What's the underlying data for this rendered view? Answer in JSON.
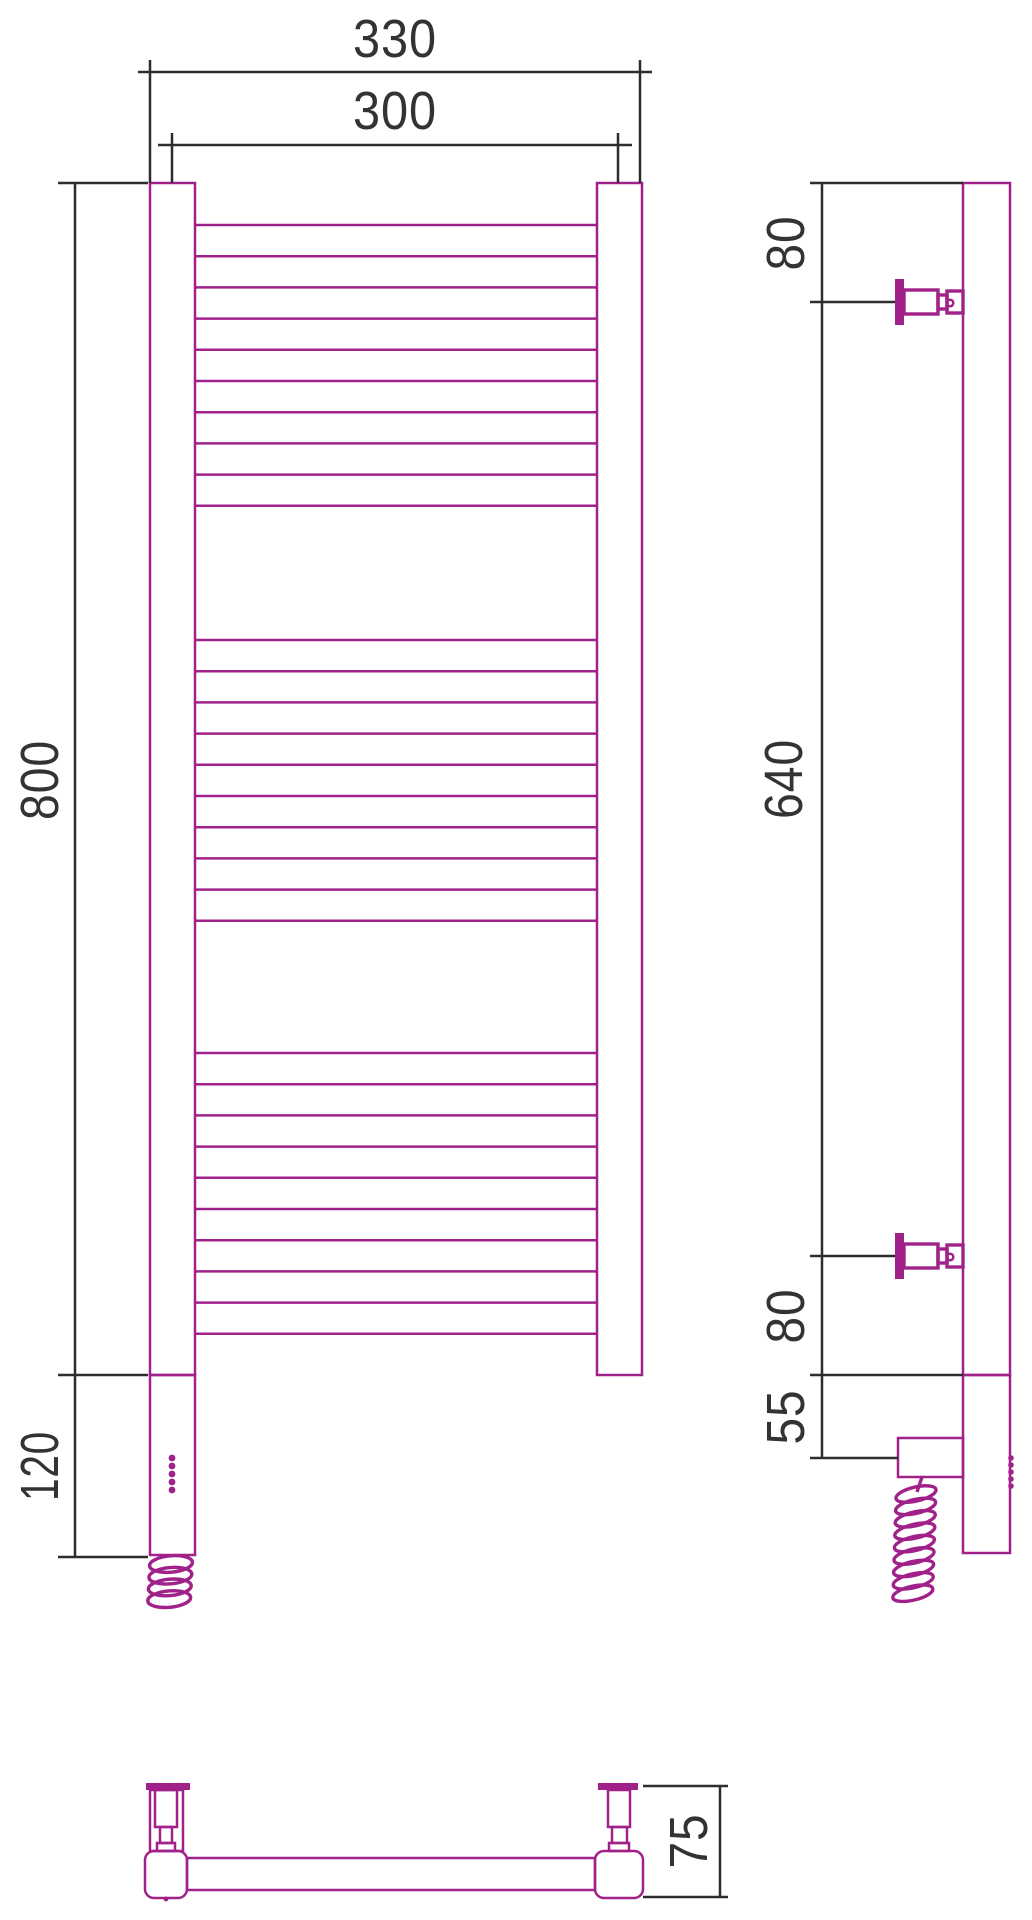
{
  "drawing": {
    "colors": {
      "outline": "#A02189",
      "dimension_lines": "#2D2D2D",
      "label_text": "#333333",
      "background": "#FFFFFF"
    },
    "views": {
      "front": {
        "dimensions": {
          "overall_width": "330",
          "mounting_width": "300",
          "height": "800",
          "heater_section": "120"
        }
      },
      "side": {
        "dimensions": {
          "top_to_bracket": "80",
          "bracket_spacing": "640",
          "bracket_to_bottom": "80",
          "bottom_to_cable": "55"
        }
      },
      "bottom": {
        "dimensions": {
          "depth": "75"
        }
      }
    }
  }
}
